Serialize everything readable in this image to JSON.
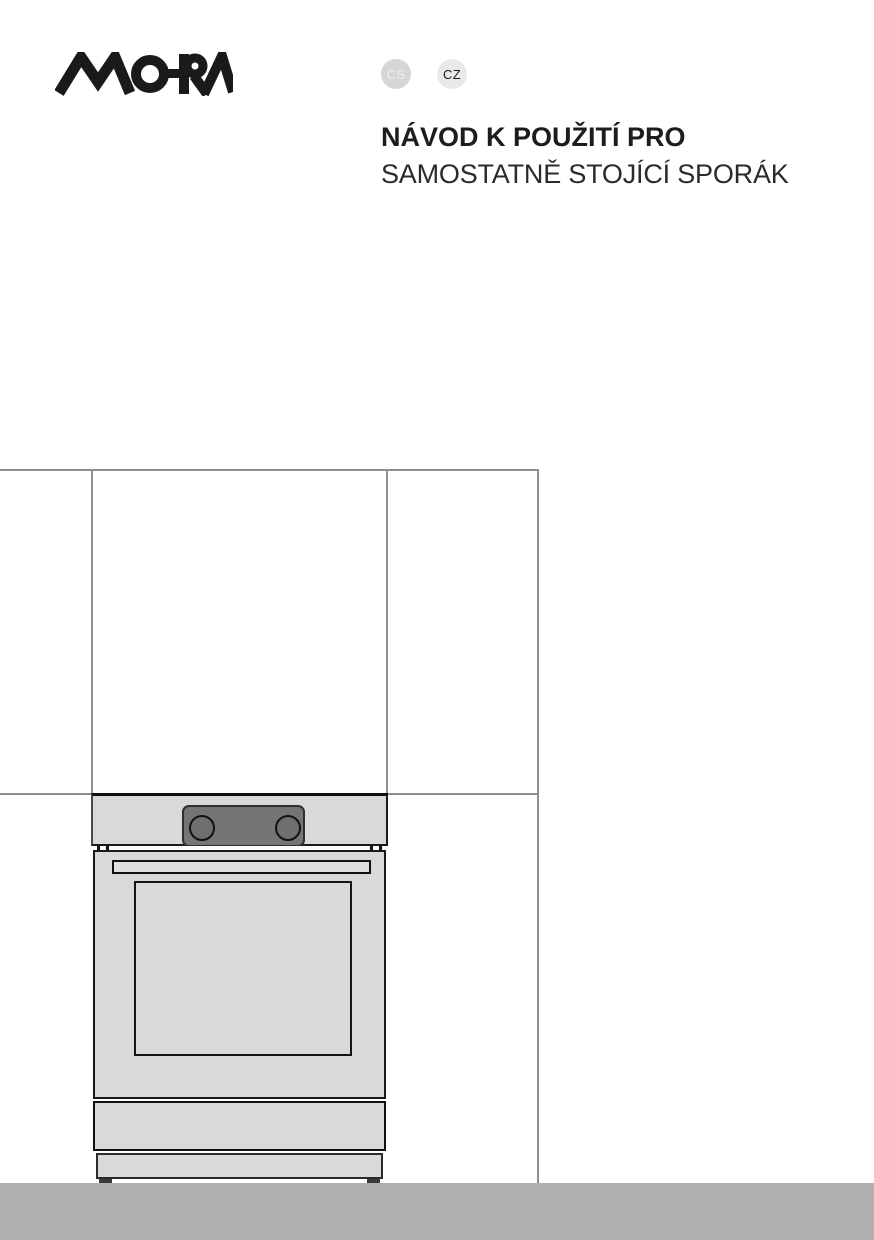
{
  "header": {
    "brand_logo": "MORA",
    "badges": [
      {
        "code": "CS",
        "bg": "#d6d6d6",
        "fg": "#f2f2f2"
      },
      {
        "code": "CZ",
        "bg": "#e9e9e9",
        "fg": "#1a1a1a"
      }
    ],
    "title_line1": "NÁVOD K POUŽITÍ PRO",
    "title_line2": "SAMOSTATNĚ STOJÍCÍ SPORÁK"
  },
  "illustration": {
    "name": "freestanding-cooker-between-kitchen-cabinets-line-drawing",
    "colors": {
      "cooker_body": "#d9d9d9",
      "control_panel": "#757575",
      "outline": "#1a1a1a",
      "guide_line": "#8f8f8f",
      "floor_bar": "#b0b0b0"
    }
  }
}
